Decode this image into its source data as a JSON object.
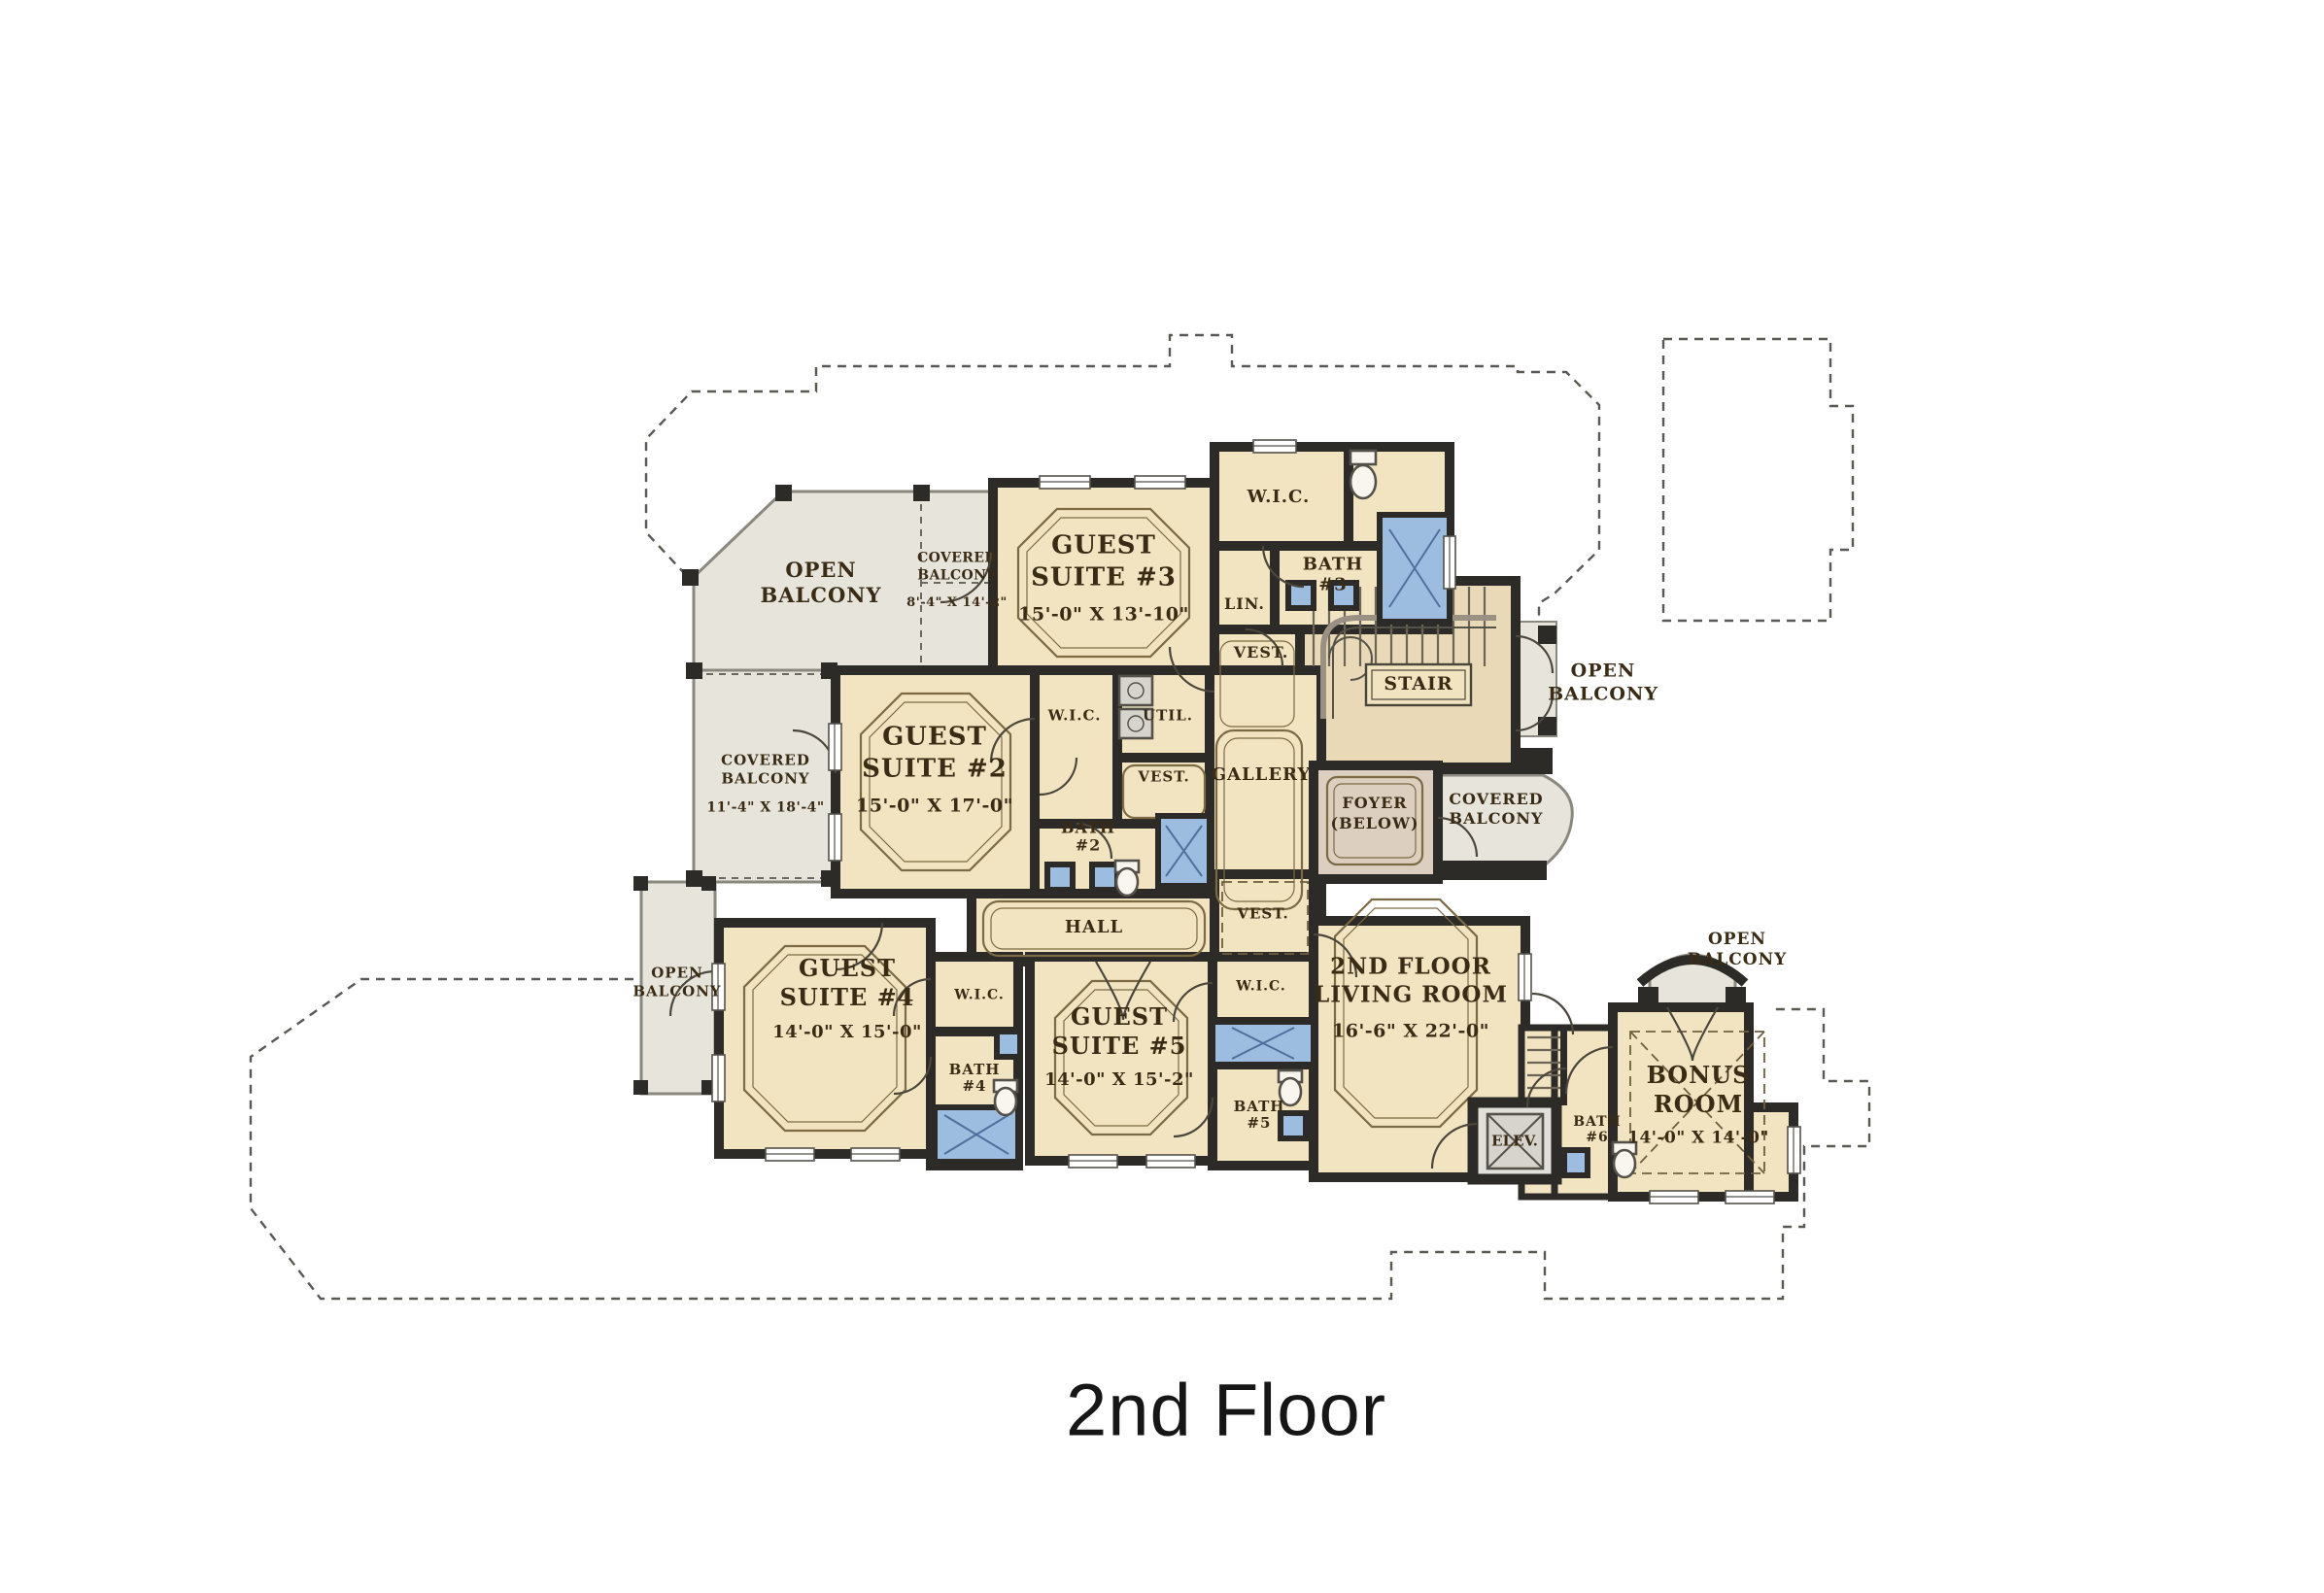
{
  "title": "2nd Floor",
  "colors": {
    "room": "#f2e4c1",
    "stair": "#e9d9b6",
    "foyer": "#dccfc0",
    "balcony": "#e6e4db",
    "water": "#9dbde0",
    "wall": "#2d2b27",
    "label": "#3a2b15"
  },
  "labels": {
    "openBalconyTL": {
      "text": "OPEN\nBALCONY"
    },
    "coveredBalconyTL": {
      "text": "COVERED\nBALCONY",
      "dims": "8'-4\" X 14'-2\""
    },
    "guest3": {
      "text": "GUEST\nSUITE #3",
      "dims": "15'-0\" X 13'-10\""
    },
    "wicTop": {
      "text": "W.I.C."
    },
    "bath3": {
      "text": "BATH\n#3"
    },
    "lin": {
      "text": "LIN."
    },
    "vestTop": {
      "text": "VEST."
    },
    "stair": {
      "text": "STAIR"
    },
    "openBalconyR": {
      "text": "OPEN\nBALCONY"
    },
    "guest2": {
      "text": "GUEST\nSUITE #2",
      "dims": "15'-0\" X 17'-0\""
    },
    "wic2": {
      "text": "W.I.C."
    },
    "util": {
      "text": "UTIL."
    },
    "vest2": {
      "text": "VEST."
    },
    "gallery": {
      "text": "GALLERY"
    },
    "foyer": {
      "text": "FOYER\n(BELOW)"
    },
    "coveredBalconyR": {
      "text": "COVERED\nBALCONY"
    },
    "coveredBalconyL": {
      "text": "COVERED\nBALCONY",
      "dims": "11'-4\" X 18'-4\""
    },
    "bath2": {
      "text": "BATH\n#2"
    },
    "hall": {
      "text": "HALL"
    },
    "vestLow": {
      "text": "VEST."
    },
    "openBalconyLL": {
      "text": "OPEN\nBALCONY"
    },
    "guest4": {
      "text": "GUEST\nSUITE #4",
      "dims": "14'-0\" X 15'-0\""
    },
    "wic4": {
      "text": "W.I.C."
    },
    "bath4": {
      "text": "BATH\n#4"
    },
    "guest5": {
      "text": "GUEST\nSUITE #5",
      "dims": "14'-0\" X 15'-2\""
    },
    "wic5": {
      "text": "W.I.C."
    },
    "bath5": {
      "text": "BATH\n#5"
    },
    "living": {
      "text": "2ND FLOOR\nLIVING ROOM",
      "dims": "16'-6\" X 22'-0\""
    },
    "elev": {
      "text": "ELEV."
    },
    "bath6": {
      "text": "BATH\n#6"
    },
    "openBalconyBR": {
      "text": "OPEN\nBALCONY"
    },
    "bonus": {
      "text": "BONUS\nROOM",
      "dims": "14'-0\" X 14'-0\""
    }
  }
}
